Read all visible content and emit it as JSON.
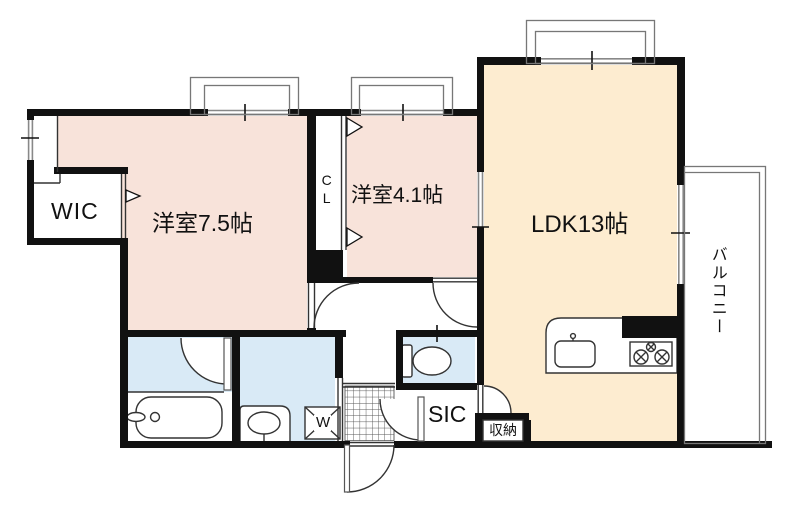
{
  "floorplan": {
    "labels": {
      "wic": "WIC",
      "bedroom_main": "洋室7.5帖",
      "closet": "CL",
      "bedroom_second": "洋室4.1帖",
      "ldk": "LDK13帖",
      "balcony": "バルコニー",
      "shoe_closet": "SIC",
      "storage": "収納",
      "washer": "W"
    },
    "colors": {
      "room_pink": "#f8e3da",
      "room_cream": "#fdecd0",
      "wet_blue": "#d9eaf6",
      "wall": "#111111"
    }
  }
}
